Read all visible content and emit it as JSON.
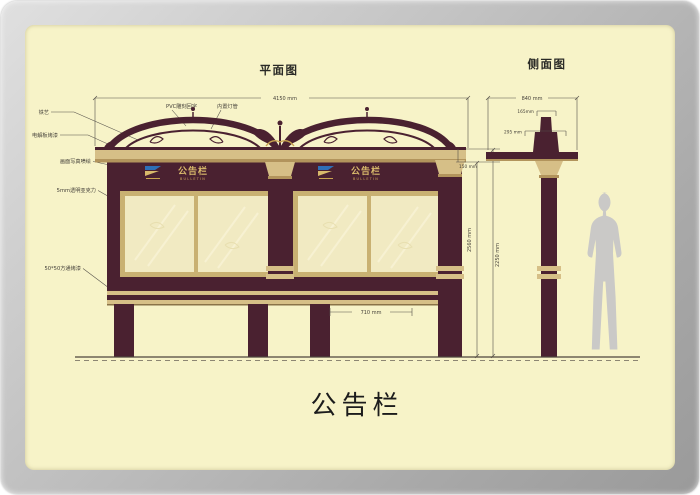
{
  "page": {
    "bottom_title": "公告栏"
  },
  "views": {
    "plan_title": "平面图",
    "side_title": "侧面图"
  },
  "board": {
    "title_cn": "公告栏",
    "title_en": "BULLETIN"
  },
  "dimensions": {
    "total_width": "4150 mm",
    "cornice_height": "150 mm",
    "height_inner": "2560 mm",
    "height_outer": "2250 mm",
    "leg_span": "710 mm",
    "side_width": "840 mm",
    "side_top": "165mm",
    "side_cap": "295 mm"
  },
  "annotations": {
    "iron_art": "铁艺",
    "panel_paint": "电解板烤漆",
    "inkjet_print": "画面写真喷绘",
    "acrylic": "5mm透明亚克力",
    "square_tube": "50*50方通烤漆",
    "pvc_carving": "PVC雕刻回字",
    "lamp": "内置灯管"
  },
  "colors": {
    "maroon": "#4a2130",
    "gold": "#d6bf87",
    "gold_dark": "#b2945c",
    "gold_text": "#d9ba6b",
    "cream_panel": "#f7f3c8",
    "glass": "#f1eac2",
    "logo_blue": "#2e6fb7",
    "silhouette_gray": "#cac9c7"
  }
}
